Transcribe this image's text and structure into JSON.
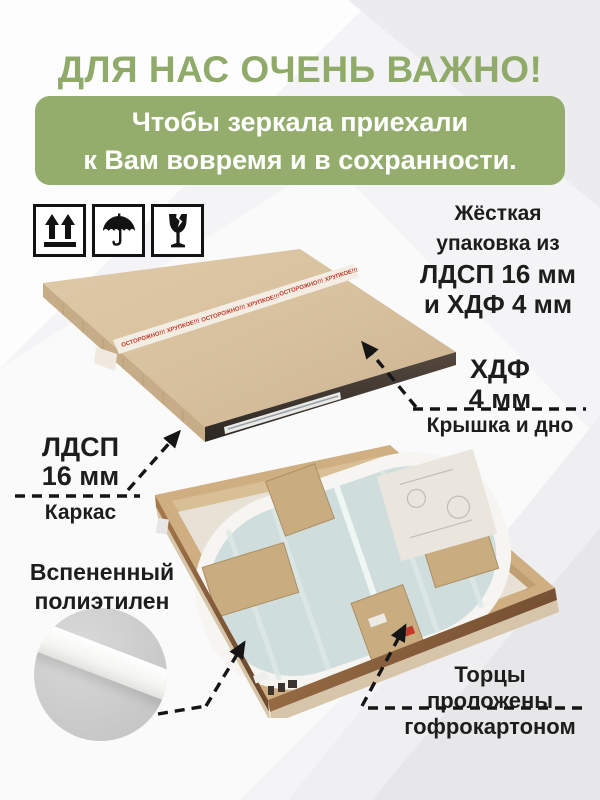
{
  "header": {
    "title": "ДЛЯ НАС ОЧЕНЬ ВАЖНО!",
    "banner_line1": "Чтобы зеркала приехали",
    "banner_line2": "к Вам вовремя и в сохранности."
  },
  "packaging_icons": [
    {
      "name": "this-side-up"
    },
    {
      "name": "keep-dry-umbrella"
    },
    {
      "name": "fragile-glass"
    }
  ],
  "labels": {
    "rigid": {
      "l1": "Жёсткая",
      "l2": "упаковка из",
      "l3": "ЛДСП 16 мм",
      "l4": "и ХДФ 4 мм"
    },
    "hdf": {
      "l1": "ХДФ",
      "l2": "4 мм",
      "caption": "Крышка и дно"
    },
    "ldsp": {
      "l1": "ЛДСП",
      "l2": "16 мм",
      "caption": "Каркас"
    },
    "foam": {
      "l1": "Вспененный",
      "l2": "полиэтилен"
    },
    "edges": {
      "l1": "Торцы",
      "l2": "проложены",
      "l3": "гофрокартоном"
    }
  },
  "photo_details": {
    "tape_text": "ОСТОРОЖНО!!! ХРУПКОЕ!!!"
  },
  "colors": {
    "accent_green": "#90ab69",
    "banner_green": "#94ad6d",
    "tape_red": "#c23b2a",
    "text_black": "#1d1d1b"
  }
}
